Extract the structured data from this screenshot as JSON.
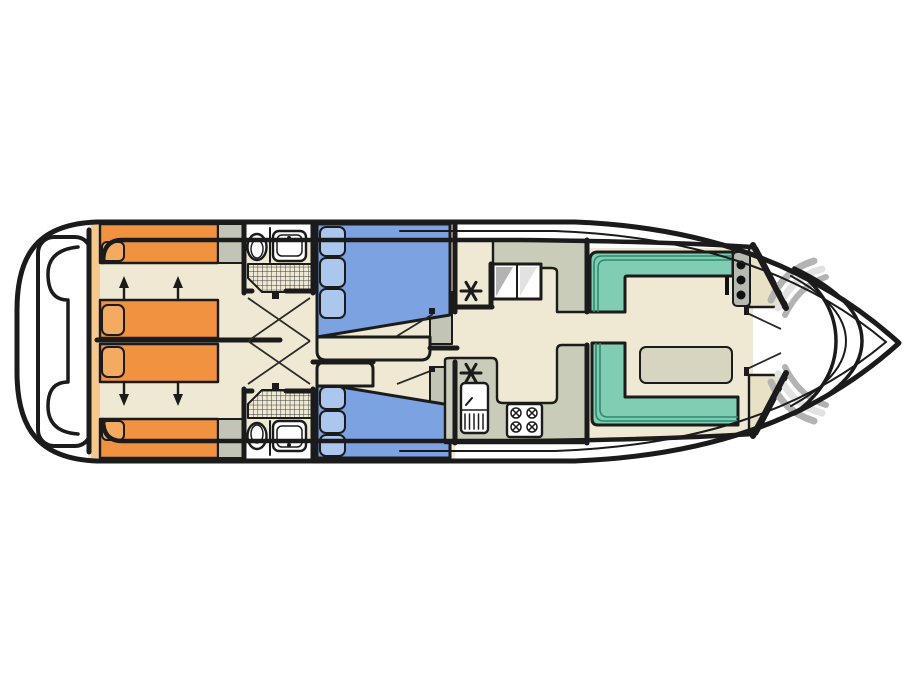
{
  "diagram": {
    "type": "boat-deck-floor-plan",
    "orientation": "bow-right",
    "rooms": [
      {
        "id": "swim-platform"
      },
      {
        "id": "aft-cabin",
        "berths": 4,
        "convertible_arrows": 4
      },
      {
        "id": "bathroom-port",
        "fixtures": [
          "toilet",
          "sink",
          "shower"
        ]
      },
      {
        "id": "bathroom-starboard",
        "fixtures": [
          "toilet",
          "sink",
          "shower"
        ]
      },
      {
        "id": "cabin-port",
        "berths": 1,
        "pillows": 3
      },
      {
        "id": "cabin-starboard",
        "berths": 1,
        "pillows": 3
      },
      {
        "id": "galley",
        "fixtures": [
          "sink-unit",
          "stove",
          "stairs",
          "wardrobe"
        ]
      },
      {
        "id": "saloon",
        "fixtures": [
          "l-bench-port",
          "u-bench-starboard",
          "table"
        ]
      },
      {
        "id": "helm",
        "gauges": 3,
        "throttle": 1
      },
      {
        "id": "bow",
        "fixtures": [
          "crescent-seat",
          "steps-port",
          "steps-starboard"
        ]
      }
    ],
    "symbols": {
      "wardrobe_marker": "asterisk",
      "stove_burners": 4,
      "helm_gauges": 3
    }
  },
  "colors": {
    "background": "#ffffff",
    "white": "#ffffff",
    "outline": "#1b1b1b",
    "floor": "#efe8d3",
    "bed_orange": "#f0923f",
    "pillow_orange": "#f4aa61",
    "shelf_tan": "#f6c88e",
    "bed_blue": "#7da2e2",
    "pillow_blue": "#abc7ee",
    "seat_teal": "#80cdb4",
    "seat_teal_line": "#2f8a71",
    "counter": "#c9ccb8",
    "table": "#d7d5bf",
    "cabinet_gray": "#c2c4b6",
    "panel_gray": "#b7bab0",
    "console_beige": "#e9e1c6",
    "step_gray": "#b3b3b3",
    "step_light": "#e2e2e2",
    "gauge_black": "#111111"
  }
}
